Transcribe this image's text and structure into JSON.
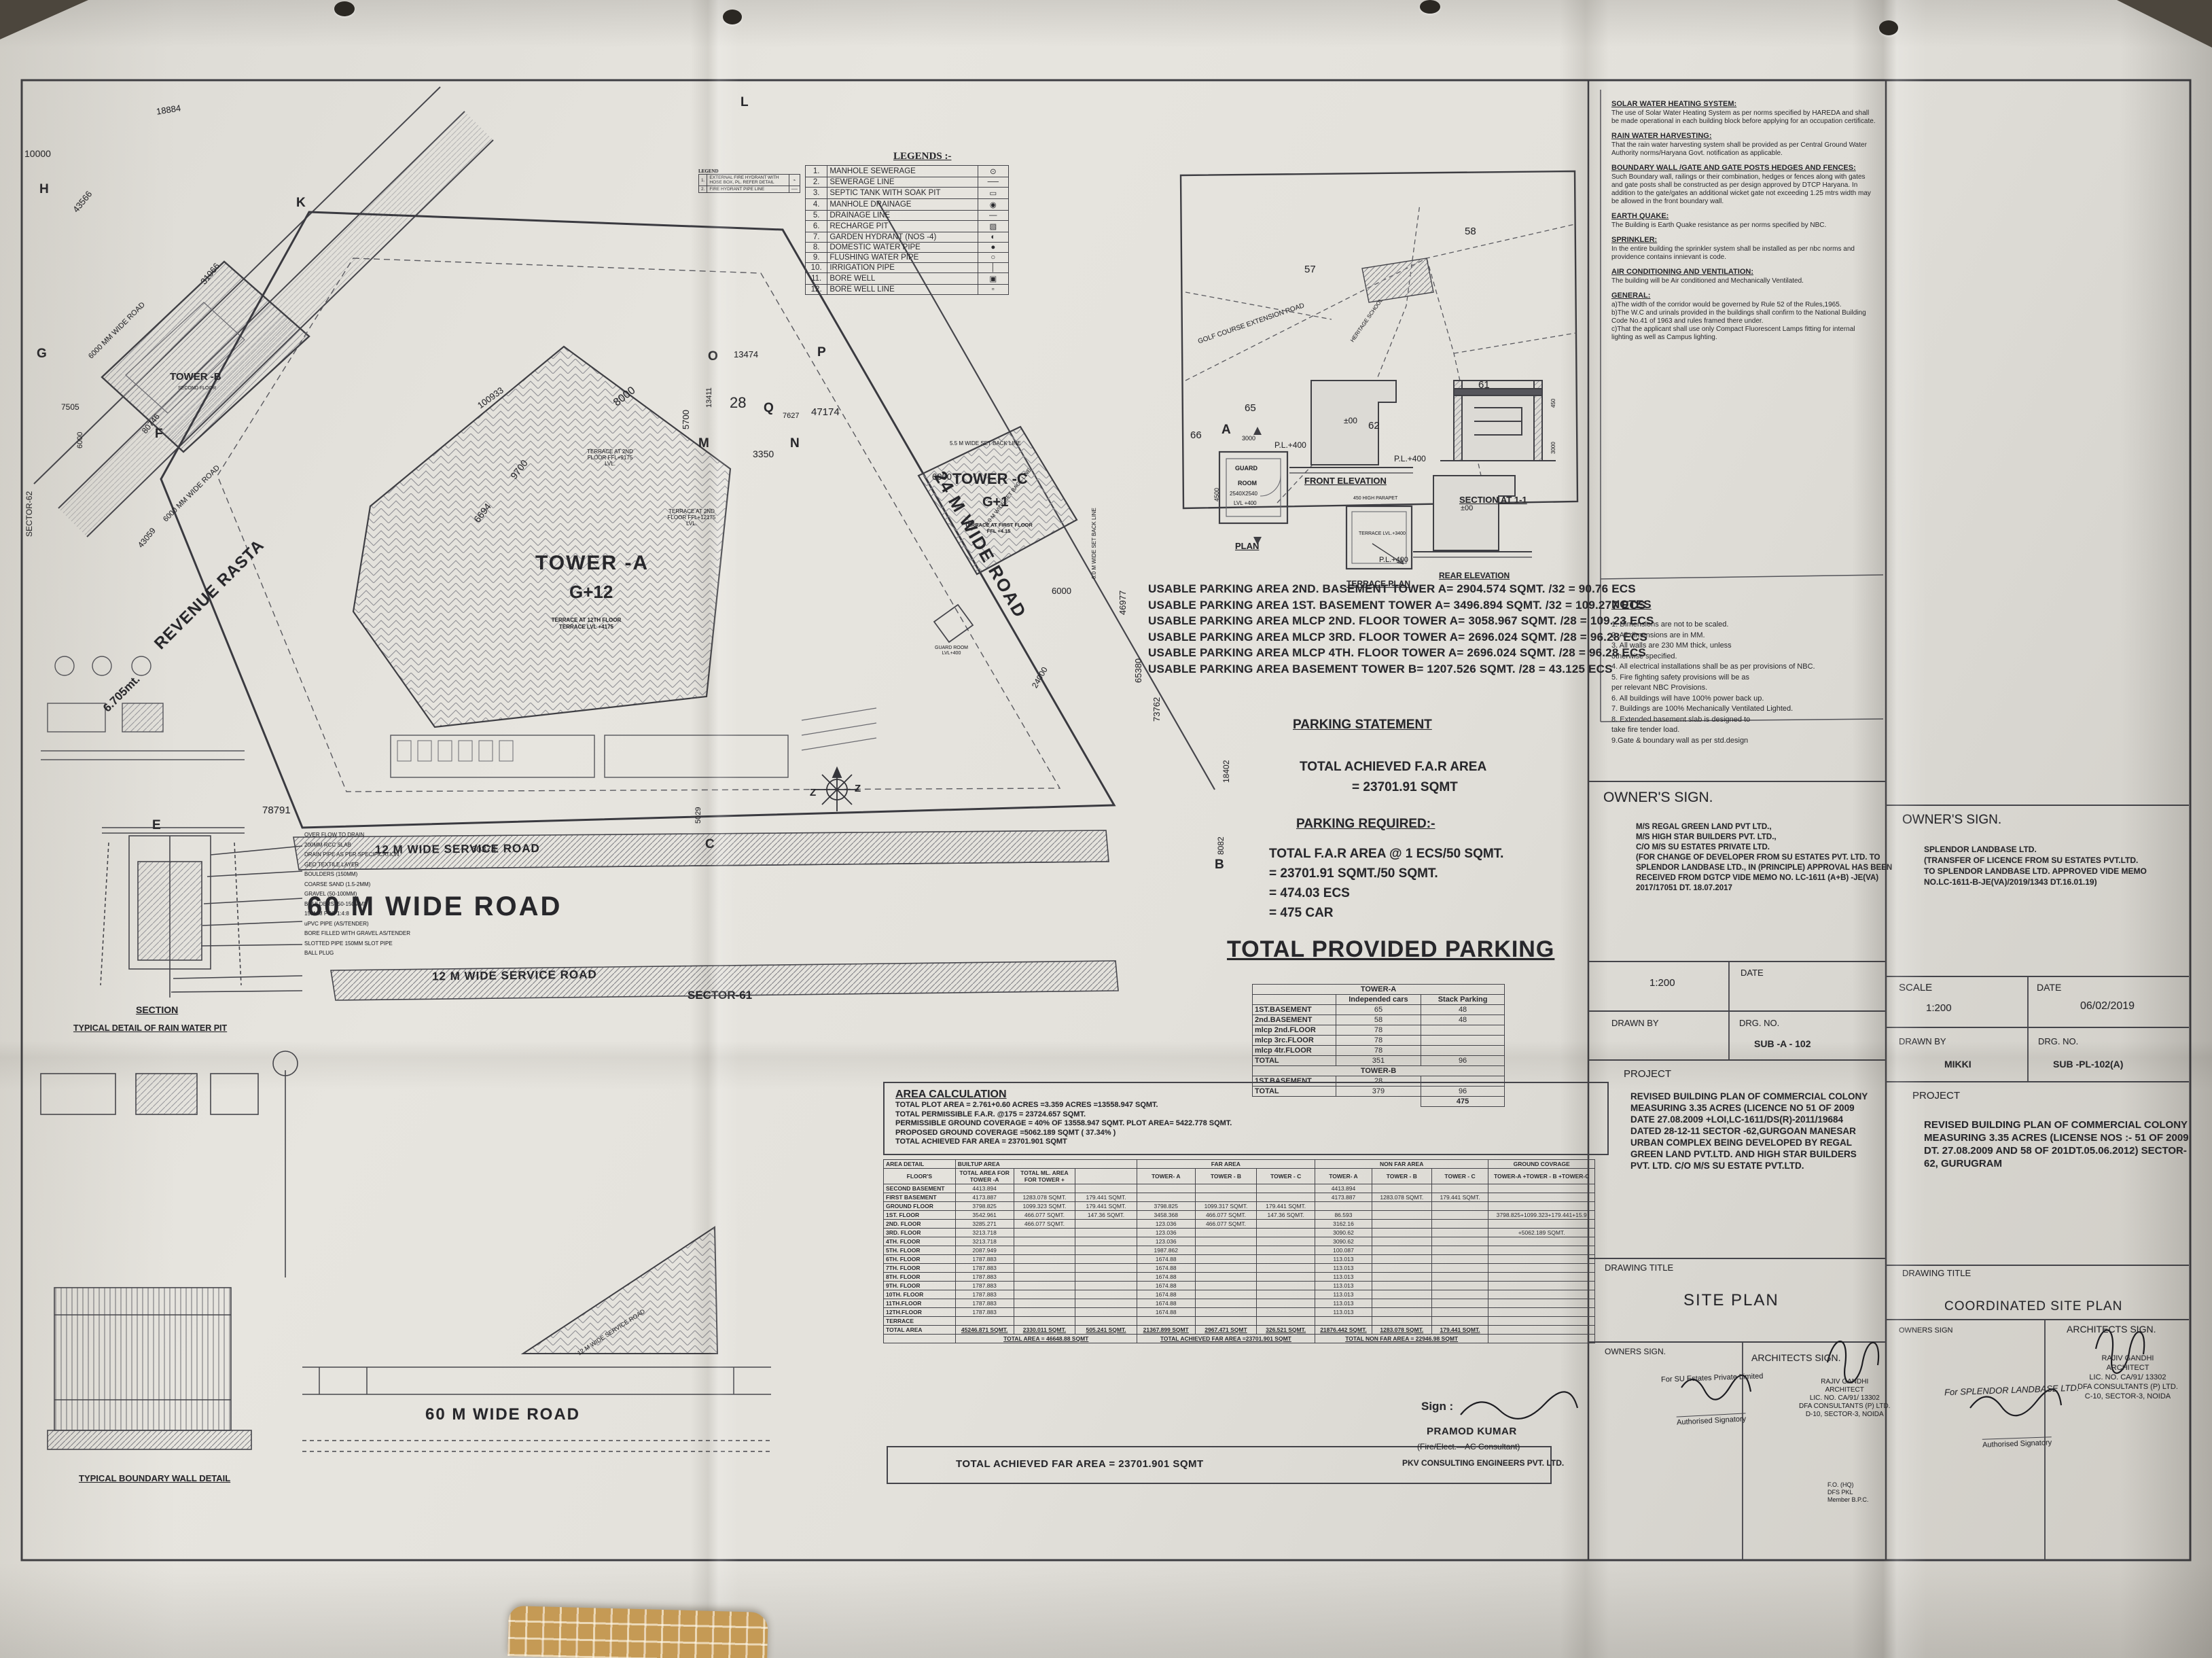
{
  "legend": {
    "title": "LEGENDS :-",
    "items": [
      {
        "n": "1.",
        "label": "MANHOLE SEWERAGE",
        "sym": "⊙"
      },
      {
        "n": "2.",
        "label": "SEWERAGE LINE",
        "sym": "──"
      },
      {
        "n": "3.",
        "label": "SEPTIC TANK WITH SOAK PIT",
        "sym": "▭"
      },
      {
        "n": "4.",
        "label": "MANHOLE DRAINAGE",
        "sym": "◉"
      },
      {
        "n": "5.",
        "label": "DRAINAGE LINE",
        "sym": "—"
      },
      {
        "n": "6.",
        "label": "RECHARGE PIT",
        "sym": "▨"
      },
      {
        "n": "7.",
        "label": "GARDEN HYDRANT (NOS -4)",
        "sym": "◐"
      },
      {
        "n": "8.",
        "label": "DOMESTIC WATER PIPE",
        "sym": "●"
      },
      {
        "n": "9.",
        "label": "FLUSHING WATER PIPE",
        "sym": "○"
      },
      {
        "n": "10.",
        "label": "IRRIGATION PIPE",
        "sym": "│"
      },
      {
        "n": "11.",
        "label": "BORE WELL",
        "sym": "▣"
      },
      {
        "n": "12.",
        "label": "BORE WELL LINE",
        "sym": "▫"
      }
    ]
  },
  "legend2": {
    "title": "LEGEND",
    "items": [
      {
        "n": "1.",
        "label": "EXTERNAL FIRE HYDRANT WITH HOSE BOX, PL. REFER DETAIL",
        "sym": "⌁"
      },
      {
        "n": "2.",
        "label": "FIRE HYDRANT PIPE LINE",
        "sym": "──"
      }
    ]
  },
  "site": {
    "tower_a": "TOWER -A",
    "tower_a_sub": "G+12",
    "tower_a_note": "TERRACE AT 12TH FLOOR TERRACE LVL +4175",
    "tower_b": "TOWER -B",
    "tower_b_note": "SECOND FLOOR",
    "tower_c": "TOWER -C",
    "tower_c_sub": "G+1",
    "tower_c_note": "TERRACE AT FIRST FLOOR FFL +4.15",
    "terrace_a2": "TERRACE AT 2ND FLOOR FFL+9175 LVL.",
    "terrace_b2": "TERRACE AT 2ND FLOOR FFL+12175 LVL.",
    "guard_plan": "GUARD ROOM LVL+400",
    "road_60m": "60 M WIDE ROAD",
    "road_12m": "12 M WIDE SERVICE ROAD",
    "road_24m": "24 M WIDE ROAD",
    "revenue_rasta": "REVENUE RASTA",
    "revenue_width": "6.705mt.",
    "road_6000": "6000 MM WIDE ROAD",
    "setback_55": "5.5 M WIDE SET BACK LINE",
    "setback_60": "6.0 M WIDE SET BACK LINE",
    "sector61": "SECTOR-61",
    "sector62": "SECTOR-62",
    "dims": [
      "10000",
      "18884",
      "43566",
      "31066",
      "100933",
      "7505",
      "6000",
      "80746",
      "43059",
      "9700",
      "6694",
      "8000",
      "78791",
      "60374",
      "5029",
      "47174",
      "13474",
      "13411",
      "28",
      "3350",
      "5700",
      "7627",
      "46977",
      "65380",
      "73762",
      "18402",
      "8082",
      "24000",
      "6000",
      "6000"
    ],
    "letters": [
      "H",
      "G",
      "F",
      "E",
      "C",
      "B",
      "A",
      "L",
      "K",
      "O",
      "M",
      "N",
      "P",
      "Q",
      "Z"
    ]
  },
  "keymap": {
    "road": "GOLF COURSE EXTENSION ROAD",
    "school": "HERITAGE SCHOOL",
    "plots": [
      "57",
      "58",
      "65",
      "66",
      "61",
      "62"
    ]
  },
  "details": {
    "guard1": "GUARD",
    "guard2": "ROOM",
    "guard3": "2540X2540",
    "guard4": "LVL +400",
    "plan": "PLAN",
    "front": "FRONT ELEVATION",
    "section": "SECTION AT 1-1",
    "terrace_plan": "TERRACE PLAN",
    "rear": "REAR ELEVATION",
    "pl400": "P.L.+400",
    "pm00": "±00",
    "parapet": "450 HIGH PARAPET",
    "terr_lvl": "TERRACE LVL.+3400",
    "d3000": "3000",
    "d4500": "4500",
    "d450": "450"
  },
  "parking": {
    "usable_lines": [
      "USABLE PARKING AREA  2ND. BASEMENT TOWER A= 2904.574 SQMT. /32 = 90.76 ECS",
      "USABLE PARKING AREA 1ST. BASEMENT TOWER A= 3496.894 SQMT. /32 = 109.277 ECS",
      "USABLE PARKING AREA MLCP 2ND. FLOOR TOWER A= 3058.967 SQMT. /28 = 109.23 ECS",
      "USABLE PARKING AREA MLCP 3RD. FLOOR TOWER A= 2696.024 SQMT. /28 = 96.28 ECS",
      "USABLE PARKING AREA MLCP 4TH. FLOOR TOWER A= 2696.024 SQMT. /28 = 96.28 ECS",
      "USABLE PARKING AREA BASEMENT TOWER B= 1207.526 SQMT. /28 = 43.125 ECS"
    ],
    "statement_title": "PARKING STATEMENT",
    "achieved_title": "TOTAL ACHIEVED  F.A.R AREA",
    "achieved_value": "= 23701.91 SQMT",
    "required_title": "PARKING REQUIRED:-",
    "required_lines": [
      "TOTAL F.A.R AREA @ 1 ECS/50 SQMT.",
      "= 23701.91 SQMT./50 SQMT.",
      "= 474.03 ECS",
      "= 475 CAR"
    ],
    "provided_title": "TOTAL PROVIDED PARKING",
    "table": {
      "tower_a": "TOWER-A",
      "tower_b": "TOWER-B",
      "col_cars": "Independed cars",
      "col_stack": "Stack Parking",
      "rows_a": [
        [
          "1ST.BASEMENT",
          "65",
          "48"
        ],
        [
          "2nd.BASEMENT",
          "58",
          "48"
        ],
        [
          "mlcp 2nd.FLOOR",
          "78",
          ""
        ],
        [
          "mlcp 3rc.FLOOR",
          "78",
          ""
        ],
        [
          "mlcp 4tr.FLOOR",
          "78",
          ""
        ],
        [
          "TOTAL",
          "351",
          "96"
        ]
      ],
      "rows_b": [
        [
          "1ST.BASEMENT",
          "28",
          ""
        ],
        [
          "TOTAL",
          "379",
          "96"
        ]
      ],
      "grand_total": "475"
    }
  },
  "area_calc": {
    "title": "AREA CALCULATION",
    "lines": [
      "TOTAL  PLOT AREA = 2.761+0.60 ACRES =3.359 ACRES =13558.947 SQMT.",
      "TOTAL PERMISSIBLE F.A.R.  @175  = 23724.657 SQMT.",
      "PERMISSIBLE GROUND COVERAGE = 40% OF 13558.947 SQMT. PLOT AREA= 5422.778 SQMT.",
      "PROPOSED GROUND COVERAGE   =5062.189 SQMT ( 37.34% )",
      "TOTAL ACHIEVED FAR AREA = 23701.901 SQMT"
    ],
    "h_area_detail": "AREA DETAIL",
    "h_builtup": "BUILTUP AREA",
    "h_far": "FAR AREA",
    "h_nonfar": "NON FAR AREA",
    "h_gc": "GROUND COVRAGE",
    "h_floors": "FLOOR'S",
    "h_total_a": "TOTAL AREA FOR TOWER -A",
    "h_total_ml": "TOTAL ML. AREA FOR TOWER +",
    "h_twr_a": "TOWER- A",
    "h_twr_b": "TOWER - B",
    "h_twr_c": "TOWER - C",
    "gc_formula": "TOWER-A +TOWER - B +TOWER-C",
    "rows": [
      [
        "SECOND BASEMENT",
        "4413.894",
        "",
        "",
        "",
        "",
        "",
        "4413.894",
        "",
        "",
        ""
      ],
      [
        "FIRST BASEMENT",
        "4173.887",
        "1283.078 SQMT.",
        "179.441 SQMT.",
        "",
        "",
        "",
        "4173.887",
        "1283.078 SQMT.",
        "179.441 SQMT.",
        ""
      ],
      [
        "GROUND FLOOR",
        "3798.825",
        "1099.323 SQMT.",
        "179.441 SQMT.",
        "3798.825",
        "1099.317 SQMT.",
        "179.441 SQMT.",
        "",
        "",
        "",
        ""
      ],
      [
        "1ST. FLOOR",
        "3542.961",
        "466.077 SQMT.",
        "147.36 SQMT.",
        "3458.368",
        "466.077 SQMT.",
        "147.36 SQMT.",
        "86.593",
        "",
        "",
        "3798.825+1099.323+179.441+15.9"
      ],
      [
        "2ND. FLOOR",
        "3285.271",
        "466.077 SQMT.",
        "",
        "123.036",
        "466.077 SQMT.",
        "",
        "3162.16",
        "",
        "",
        ""
      ],
      [
        "3RD. FLOOR",
        "3213.718",
        "",
        "",
        "123.036",
        "",
        "",
        "3090.62",
        "",
        "",
        "+5062.189 SQMT."
      ],
      [
        "4TH. FLOOR",
        "3213.718",
        "",
        "",
        "123.036",
        "",
        "",
        "3090.62",
        "",
        "",
        ""
      ],
      [
        "5TH. FLOOR",
        "2087.949",
        "",
        "",
        "1987.862",
        "",
        "",
        "100.087",
        "",
        "",
        ""
      ],
      [
        "6TH. FLOOR",
        "1787.883",
        "",
        "",
        "1674.88",
        "",
        "",
        "113.013",
        "",
        "",
        ""
      ],
      [
        "7TH. FLOOR",
        "1787.883",
        "",
        "",
        "1674.88",
        "",
        "",
        "113.013",
        "",
        "",
        ""
      ],
      [
        "8TH. FLOOR",
        "1787.883",
        "",
        "",
        "1674.88",
        "",
        "",
        "113.013",
        "",
        "",
        ""
      ],
      [
        "9TH. FLOOR",
        "1787.883",
        "",
        "",
        "1674.88",
        "",
        "",
        "113.013",
        "",
        "",
        ""
      ],
      [
        "10TH. FLOOR",
        "1787.883",
        "",
        "",
        "1674.88",
        "",
        "",
        "113.013",
        "",
        "",
        ""
      ],
      [
        "11TH.FLOOR",
        "1787.883",
        "",
        "",
        "1674.88",
        "",
        "",
        "113.013",
        "",
        "",
        ""
      ],
      [
        "12TH.FLOOR",
        "1787.883",
        "",
        "",
        "1674.88",
        "",
        "",
        "113.013",
        "",
        "",
        ""
      ],
      [
        "TERRACE",
        "",
        "",
        "",
        "",
        "",
        "",
        "",
        "",
        "",
        ""
      ]
    ],
    "total_row": [
      "TOTAL AREA",
      "45246.871 SQMT.",
      "2330.011 SQMT.",
      "505.241 SQMT.",
      "21367.899 SQMT",
      "2967.471 SQMT",
      "326.521 SQMT.",
      "21876.442 SQMT.",
      "1283.078 SQMT.",
      "179.441 SQMT.",
      ""
    ],
    "sum_builtup": "TOTAL AREA = 46648.88 SQMT",
    "sum_far": "TOTAL ACHIEVED FAR AREA =23701.901 SQMT",
    "sum_nonfar": "TOTAL NON FAR AREA = 22946.98 SQMT",
    "bottom_line": "TOTAL ACHIEVED FAR AREA = 23701.901 SQMT",
    "sign_label": "Sign :",
    "signer_name": "PRAMOD KUMAR",
    "signer_role": "(Fire/Elect.—AC Consultant)",
    "signer_co": "PKV CONSULTING ENGINEERS PVT. LTD."
  },
  "notes_col": {
    "sections": [
      {
        "h": "SOLAR WATER HEATING SYSTEM:",
        "body": "The use of Solar Water Heating System as per norms specified by HAREDA and shall be made operational in each building block before applying for an occupation certificate."
      },
      {
        "h": "RAIN WATER HARVESTING:",
        "body": "That the rain water harvesting system shall be provided as per Central Ground Water Authority norms/Haryana Govt. notification as applicable."
      },
      {
        "h": "BOUNDARY WALL /GATE AND GATE POSTS HEDGES AND FENCES:",
        "body": "Such Boundary wall, railings or their combination, hedges or fences along with gates and gate posts shall be constructed as per design approved by DTCP Haryana. In addition to the gate/gates an additional wicket gate not exceeding 1.25 mtrs width may be allowed in the front boundary wall."
      },
      {
        "h": "EARTH QUAKE:",
        "body": "The Building is Earth Quake resistance as per norms specified by NBC."
      },
      {
        "h": "SPRINKLER:",
        "body": "In the entire building the sprinkler system shall be installed as per nbc norms and providence contains innievant is code."
      },
      {
        "h": "AIR CONDITIONING AND VENTILATION:",
        "body": "The building will be Air conditioned and Mechanically Ventilated."
      }
    ],
    "general_h": "GENERAL:",
    "general": [
      "a)The width of the corridor would be governed by Rule 52 of the Rules,1965.",
      "b)The W.C and urinals provided in the buildings shall confirm to the National Building Code No.41 of 1963 and rules framed there under.",
      "c)That the applicant shall use only Compact Fluorescent Lamps fitting for internal lighting as well as Campus lighting."
    ],
    "notes_title": "NOTES",
    "items": [
      "1. Dimensions are not to be scaled.",
      "2. All dimensions are in MM.",
      "3. All walls are 230 MM thick, unless",
      "    otherwise specified.",
      "4. All electrical installations shall be as per provisions of   NBC.",
      "5. Fire fighting safety provisions will be as",
      "    per relevant NBC Provisions.",
      "6. All buildings will have 100% power back up.",
      "7. Buildings are 100% Mechanically Ventilated Lighted.",
      "8. Extended basement slab is designed to",
      "    take fire tender load.",
      "9.Gate & boundary wall as per  std.design"
    ]
  },
  "tb_left": {
    "owners_title": "OWNER'S SIGN.",
    "owner_lines": [
      "M/S REGAL GREEN LAND PVT LTD.,",
      "M/S HIGH STAR BUILDERS PVT. LTD.,",
      "C/O M/S SU ESTATES PRIVATE LTD.",
      "(FOR CHANGE OF DEVELOPER FROM SU ESTATES PVT. LTD. TO",
      "SPLENDOR LANDBASE LTD., IN (PRINCIPLE) APPROVAL HAS BEEN",
      "RECEIVED FROM DGTCP VIDE MEMO NO. LC-1611 (A+B) -JE(VA)",
      "2017/17051 DT. 18.07.2017"
    ],
    "scale_value": "1:200",
    "date_label": "DATE",
    "drawn_label": "DRAWN BY",
    "drg_label": "DRG. NO.",
    "drg_value": "SUB -A - 102",
    "project_label": "PROJECT",
    "project_text": "REVISED BUILDING PLAN OF COMMERCIAL COLONY MEASURING 3.35 ACRES (LICENCE NO 51 OF 2009 DATE 27.08.2009 +LOI,LC-1611/DS(R)-2011/19684 DATED 28-12-11 SECTOR -62,GURGOAN MANESAR URBAN COMPLEX BEING DEVELOPED BY REGAL GREEN LAND PVT.LTD. AND HIGH STAR BUILDERS PVT. LTD. C/O M/S SU ESTATE PVT.LTD.",
    "drawing_title_label": "DRAWING TITLE",
    "drawing_title": "SITE PLAN",
    "owners2_title": "OWNERS SIGN.",
    "owner_for": "For SU Estates Private Limited",
    "auth": "Authorised Signatory",
    "arch_title": "ARCHITECTS SIGN.",
    "arch_lines": [
      "RAJIV GANDHI",
      "ARCHITECT",
      "LIC. NO. CA/91/ 13302",
      "DFA CONSULTANTS (P) LTD.",
      "D-10, SECTOR-3, NOIDA"
    ],
    "fo_lines": [
      "F.O. (HQ)",
      "DFS PKL",
      "Member B.P.C."
    ]
  },
  "tb_right": {
    "owners_title": "OWNER'S SIGN.",
    "owner_lines": [
      "SPLENDOR LANDBASE LTD.",
      "(TRANSFER OF LICENCE FROM SU ESTATES PVT.LTD.",
      "TO SPLENDOR LANDBASE LTD. APPROVED VIDE MEMO",
      "NO.LC-1611-B-JE(VA)/2019/1343 DT.16.01.19)"
    ],
    "scale_label": "SCALE",
    "scale_value": "1:200",
    "date_label": "DATE",
    "date_value": "06/02/2019",
    "drawn_label": "DRAWN BY",
    "drawn_value": "MIKKI",
    "drg_label": "DRG. NO.",
    "drg_value": "SUB -PL-102(A)",
    "project_label": "PROJECT",
    "project_text": "REVISED BUILDING PLAN OF COMMERCIAL COLONY MEASURING 3.35 ACRES (LICENSE NOS :- 51 OF 2009 DT. 27.08.2009 AND 58 OF 201DT.05.06.2012) SECTOR-62, GURUGRAM",
    "drawing_title_label": "DRAWING TITLE",
    "drawing_title": "COORDINATED SITE PLAN",
    "owners2_title": "OWNERS SIGN",
    "owner_for": "For SPLENDOR LANDBASE LTD.",
    "auth": "Authorised Signatory",
    "arch_title": "ARCHITECTS SIGN.",
    "arch_lines": [
      "RAJIV GANDHI",
      "ARCHITECT",
      "LIC. NO. CA/91/ 13302",
      "DFA CONSULTANTS (P) LTD.",
      "C-10, SECTOR-3, NOIDA"
    ]
  },
  "left_details": {
    "labels": [
      "OVER FLOW TO DRAIN",
      "200MM RCC SLAB",
      "DRAIN PIPE AS PER SPECIFICATION",
      "GEO TEXTILE LAYER",
      "BOULDERS (150MM)",
      "COARSE SAND (1.5-2MM)",
      "GRAVEL (50-100MM)",
      "BOULDERS (50-150MM)",
      "150MM PCC 1:4:8",
      "uPVC PIPE (AS/TENDER)",
      "BORE FILLED WITH GRAVEL AS/TENDER",
      "SLOTTED PIPE 150MM SLOT PIPE",
      "BALL PLUG"
    ],
    "section": "SECTION",
    "rain_pit": "TYPICAL DETAIL OF RAIN WATER PIT",
    "boundary": "TYPICAL BOUNDARY WALL DETAIL"
  }
}
